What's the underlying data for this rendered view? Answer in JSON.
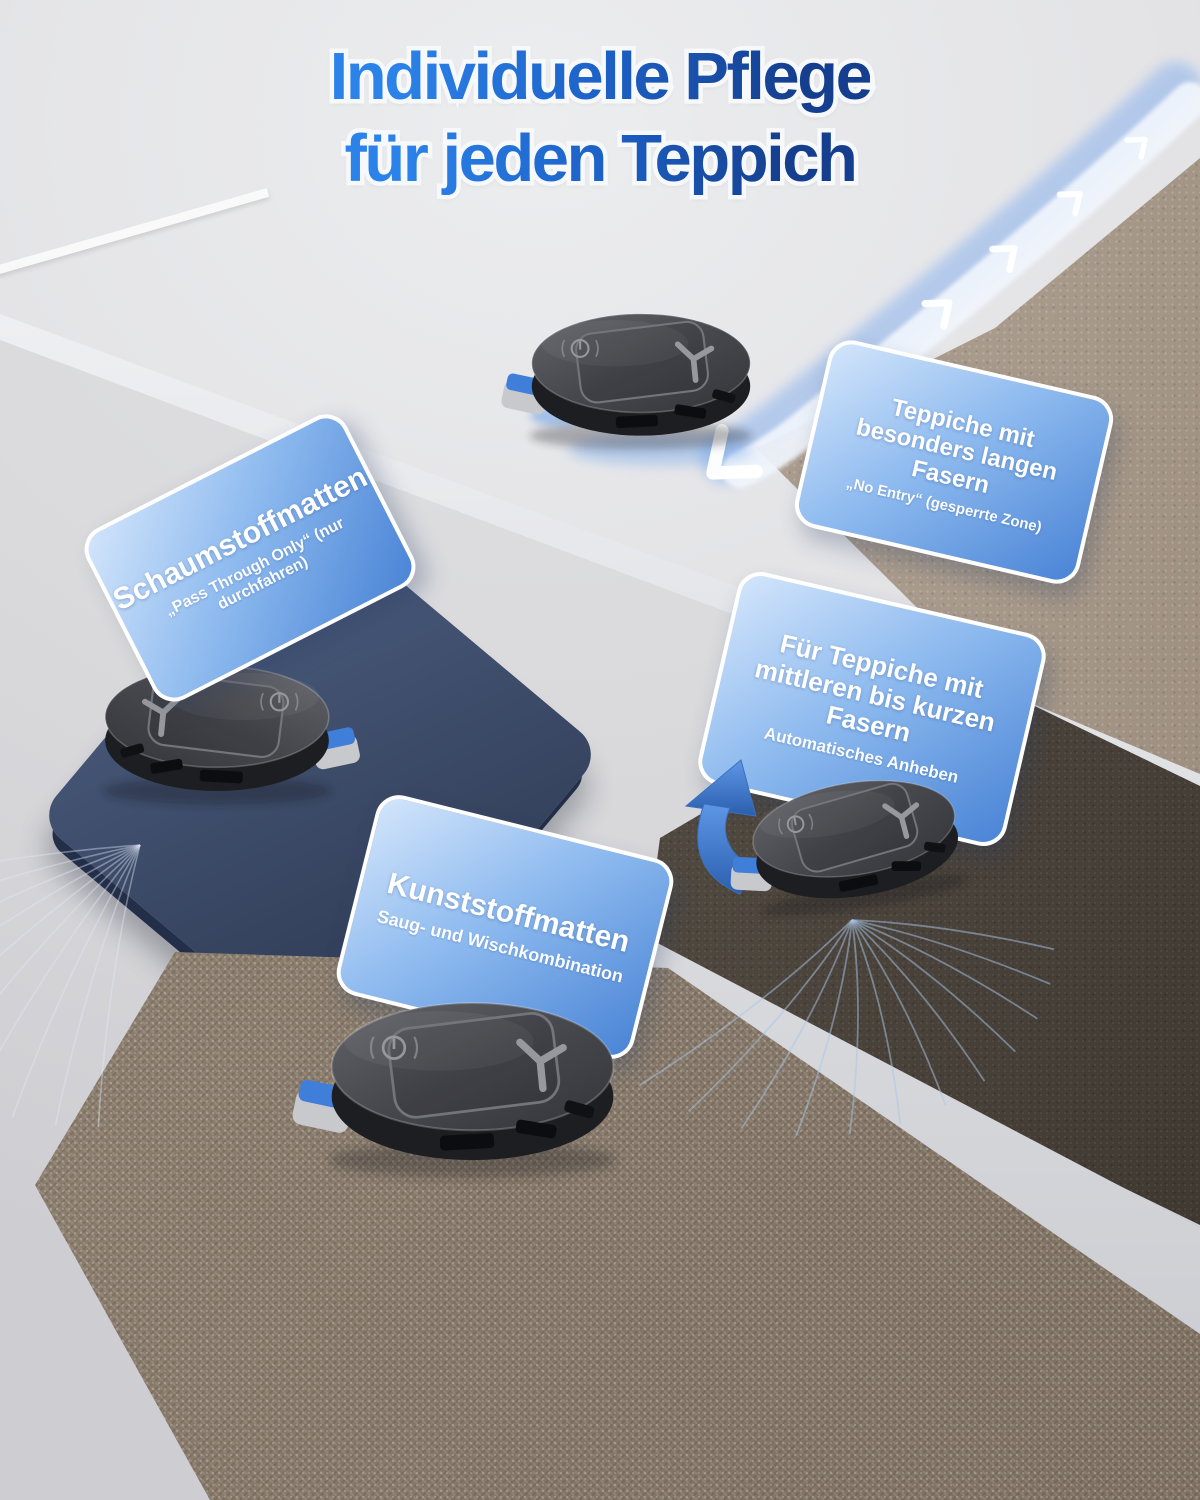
{
  "title": {
    "line1": "Individuelle Pflege",
    "line2": "für jeden Teppich"
  },
  "callouts": {
    "foam_mats": {
      "title": "Schaumstoffmatten",
      "subtitle": "„Pass Through Only“ (nur durchfahren)"
    },
    "long_fiber_carpets": {
      "title_line1": "Teppiche mit",
      "title_line2": "besonders langen Fasern",
      "subtitle": "„No Entry“ (gesperrte Zone)"
    },
    "short_fiber_carpets": {
      "title_line1": "Für Teppiche mit",
      "title_line2": "mittleren bis kurzen Fasern",
      "subtitle": "Automatisches Anheben"
    },
    "plastic_mats": {
      "title": "Kunststoffmatten",
      "subtitle": "Saug- und Wischkombination"
    }
  },
  "icons": {
    "robot_brand_logo": "Y",
    "power_button": "⏻",
    "lift_arrow": "⬆",
    "path_chevron": "❯"
  },
  "colors": {
    "title_gradient_start": "#2b82e8",
    "title_gradient_end": "#153f8e",
    "card_gradient_light": "#d3e5fb",
    "card_gradient_dark": "#4a84d6",
    "card_border": "#ffffff",
    "card_text": "#ffffff",
    "no_entry_path_blue": "#78a8ee",
    "lift_arrow_blue": "#2f6fc8",
    "foam_mat_navy": "#3d4c6b",
    "long_fiber_carpet_taupe": "#a99a8c",
    "short_fiber_carpet_brown": "#544c43",
    "plastic_mat_brown": "#867869",
    "floor_gray": "#e3e3e6",
    "robot_body": "#2a2b2f"
  }
}
